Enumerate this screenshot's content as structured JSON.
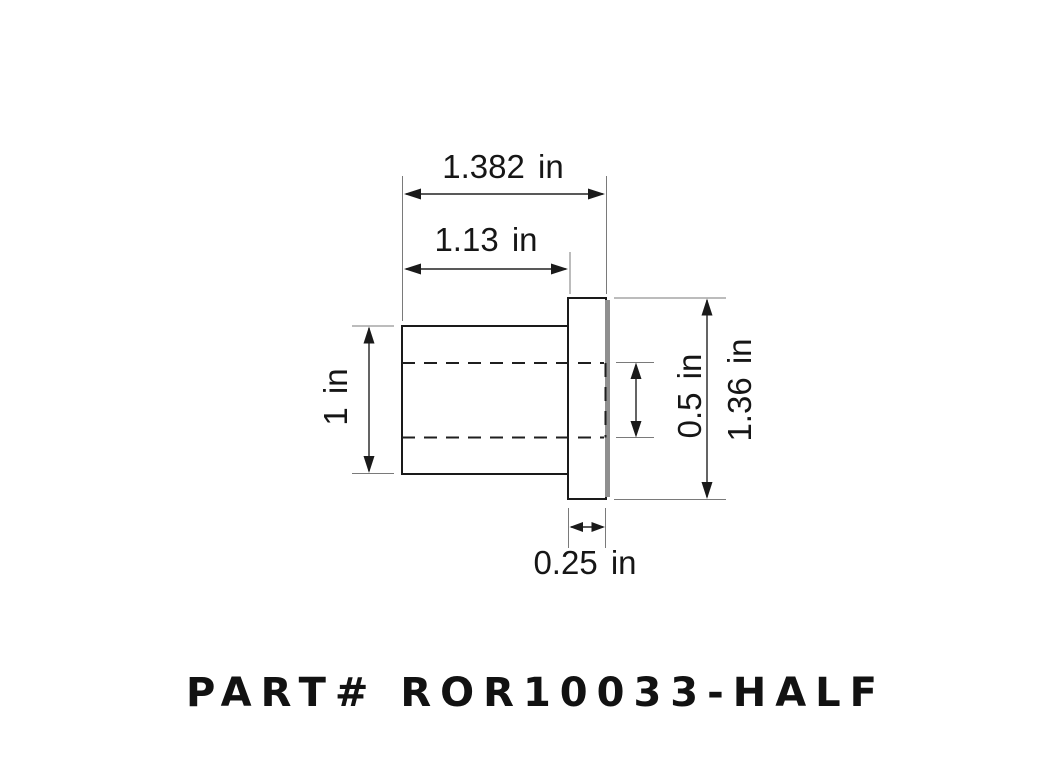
{
  "drawing": {
    "title": "flanged-bushing-technical-drawing",
    "dimensions": {
      "overall_length": "1.382 in",
      "body_length": "1.13 in",
      "body_outer_diameter": "1 in",
      "bore_inner_diameter": "0.5 in",
      "flange_outer_diameter": "1.36 in",
      "flange_thickness": "0.25 in"
    },
    "part_number_label": "PART# ROR10033-HALF"
  },
  "colors": {
    "background": "#ffffff",
    "outline": "#1a1a1a",
    "extension_line": "#7a7a7a",
    "dimension_line": "#222222",
    "flange_shadow": "#8f8f8f",
    "text": "#161616"
  }
}
